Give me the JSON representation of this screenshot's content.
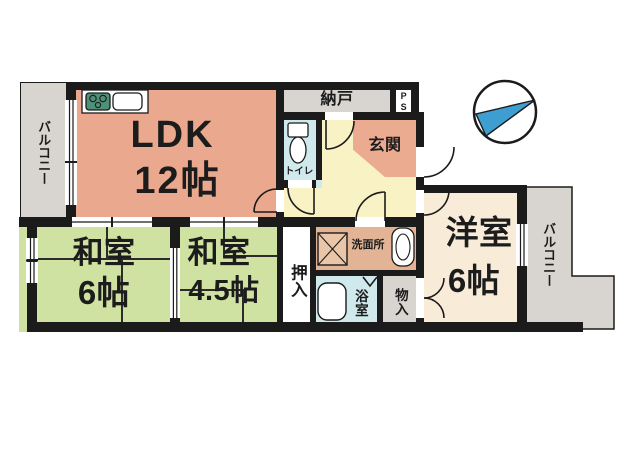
{
  "plan": {
    "type": "floor-plan",
    "rooms": {
      "ldk": {
        "name": "LDK",
        "size": "12帖"
      },
      "washitsu6": {
        "name": "和室",
        "size": "6帖"
      },
      "washitsu45": {
        "name": "和室",
        "size": "4.5帖"
      },
      "youshitsu": {
        "name": "洋室",
        "size": "6帖"
      },
      "genkan": "玄関",
      "nando": "納戸",
      "ps": "PS",
      "toire": "トイレ",
      "senmenjo": "洗面所",
      "yokushitsu": "浴室",
      "mononoire": "物入",
      "oshiire": "押入",
      "balcony_left": "バルコニー",
      "balcony_right": "バルコニー"
    },
    "icons": [
      "stove-icon",
      "kitchen-sink-icon",
      "toilet-icon",
      "washing-machine-icon",
      "vanity-sink-icon",
      "bathtub-icon",
      "compass-icon",
      "door-swing-icon",
      "folding-door-icon",
      "window-icon"
    ],
    "colors": {
      "wall": "#1b1b1b",
      "ldk_pink": "#eaa98f",
      "genkan_pink": "#ebab90",
      "tatami_green": "#cfe2a2",
      "hall_yellow": "#f9f2c4",
      "water_blue": "#cfe9ec",
      "senmenjo_tan": "#e2b495",
      "storage_gray": "#d8d4cf",
      "western_cream": "#f8ecd9",
      "stove_green": "#4f9178",
      "compass_blue": "#3f9ed0"
    }
  }
}
